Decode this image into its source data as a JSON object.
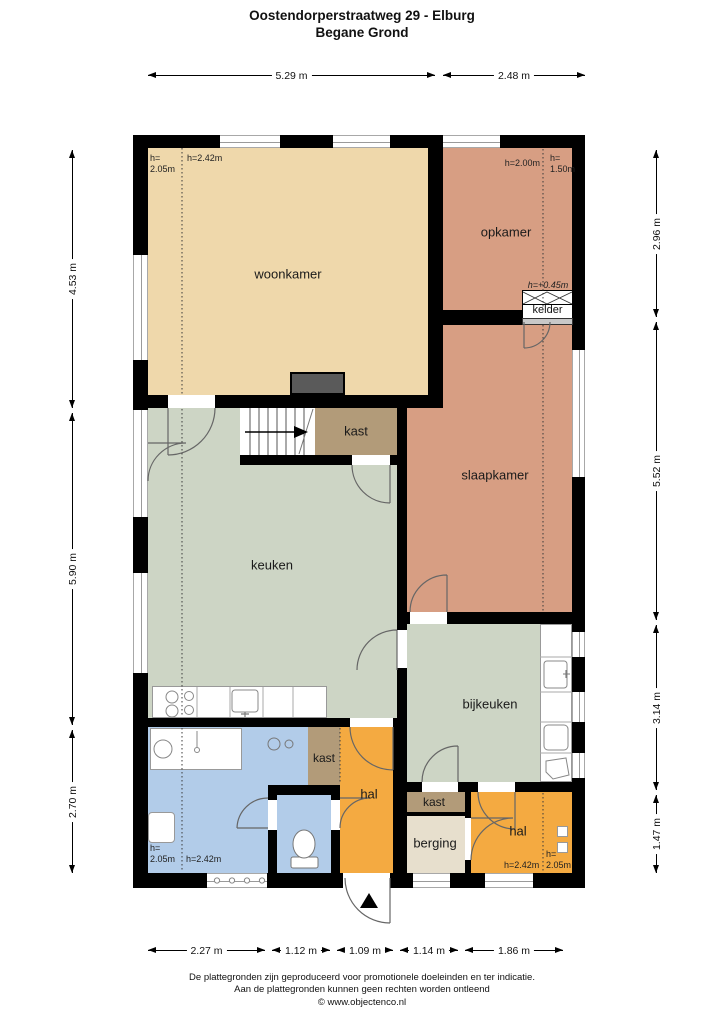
{
  "title": {
    "line1": "Oostendorperstraatweg 29 - Elburg",
    "line2": "Begane Grond"
  },
  "rooms": {
    "woonkamer": "woonkamer",
    "opkamer": "opkamer",
    "kelder": "kelder",
    "slaapkamer": "slaapkamer",
    "keuken": "keuken",
    "bijkeuken": "bijkeuken",
    "kast": "kast",
    "hal": "hal",
    "berging": "berging"
  },
  "heights": {
    "woonkamer_left": "h=\n2.05m",
    "woonkamer_right": "h=2.42m",
    "opkamer_left": "h=2.00m",
    "opkamer_right": "h=\n1.50m",
    "kelder": "h=+0.45m",
    "badkamer_left": "h=\n2.05m",
    "badkamer_right": "h=2.42m",
    "hal_left": "h=2.42m",
    "hal_right": "h=\n2.05m"
  },
  "dimensions": {
    "top": [
      "5.29 m",
      "2.48 m"
    ],
    "bottom": [
      "2.27 m",
      "1.12 m",
      "1.09 m",
      "1.14 m",
      "1.86 m"
    ],
    "left": [
      "4.53 m",
      "5.90 m",
      "2.70 m"
    ],
    "right": [
      "2.96 m",
      "5.52 m",
      "3.14 m",
      "1.47 m"
    ]
  },
  "footer": {
    "line1": "De plattegronden zijn geproduceerd voor promotionele doeleinden en ter indicatie.",
    "line2": "Aan de plattegronden kunnen geen rechten worden ontleend",
    "line3": "© www.objectenco.nl"
  },
  "colors": {
    "woonkamer": "#efd8ab",
    "opkamer_slaapkamer": "#d79e83",
    "keuken_bijkeuken": "#cdd5c5",
    "badkamer": "#b2cce9",
    "hal": "#f4aa41",
    "kast": "#b29b79",
    "berging": "#e7dfcd",
    "wall": "#000000",
    "fireplace": "#5a5a5a"
  }
}
